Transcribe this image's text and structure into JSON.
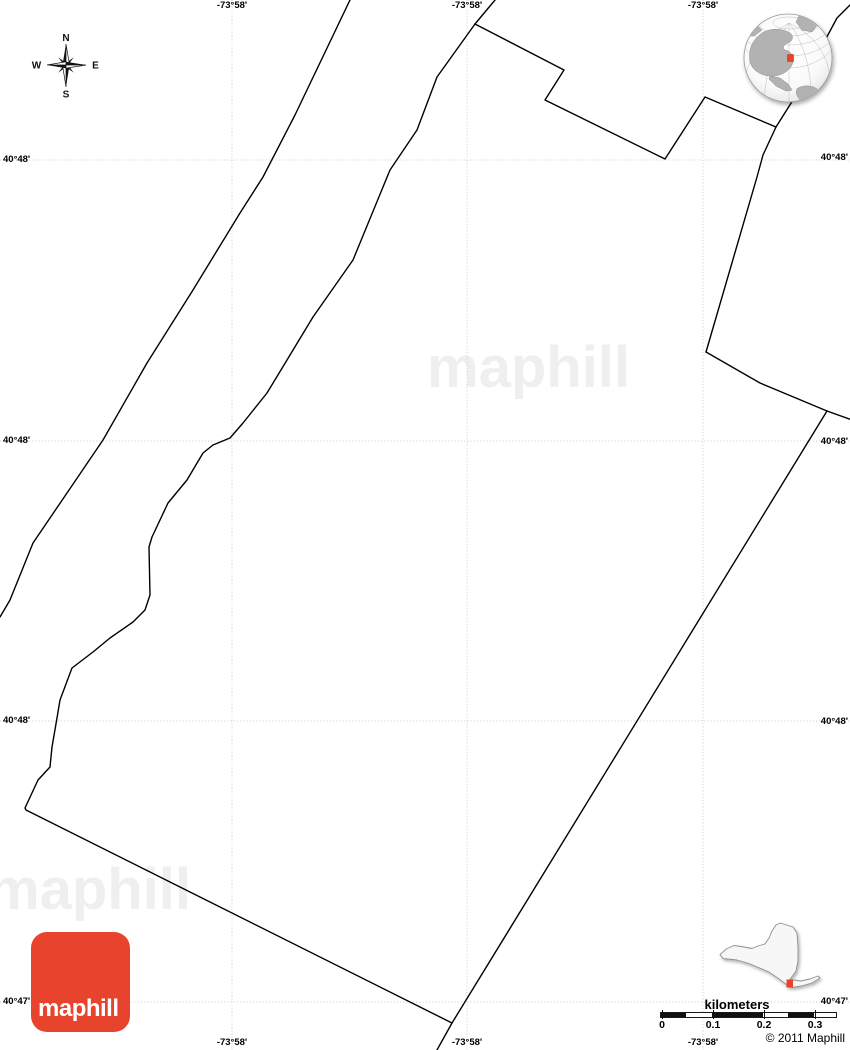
{
  "watermark": {
    "text": "maphill",
    "color": "#efefef"
  },
  "compass": {
    "north": "N",
    "east": "E",
    "south": "S",
    "west": "W"
  },
  "grid": {
    "line_color": "#cccccc",
    "vertical_x": [
      232,
      467,
      703
    ],
    "horizontal_y": [
      160,
      441,
      721,
      1002
    ],
    "top_labels": [
      "-73°58'",
      "-73°58'",
      "-73°58'"
    ],
    "bottom_labels": [
      "-73°58'",
      "-73°58'",
      "-73°58'"
    ],
    "left_labels": [
      "40°48'",
      "40°48'",
      "40°48'",
      "40°47'"
    ],
    "right_labels": [
      "40°48'",
      "40°48'",
      "40°48'",
      "40°47'"
    ]
  },
  "boundaries": {
    "color": "#000000",
    "lines": {
      "west_outer": [
        [
          350,
          0
        ],
        [
          295,
          115
        ],
        [
          263,
          177
        ],
        [
          240,
          213
        ],
        [
          193,
          290
        ],
        [
          147,
          363
        ],
        [
          103,
          440
        ],
        [
          67,
          493
        ],
        [
          33,
          543
        ],
        [
          10,
          600
        ],
        [
          0,
          617
        ]
      ],
      "district_west_south": [
        [
          495,
          0
        ],
        [
          475,
          24
        ],
        [
          437,
          77
        ],
        [
          417,
          130
        ],
        [
          390,
          170
        ],
        [
          353,
          260
        ],
        [
          313,
          317
        ],
        [
          287,
          360
        ],
        [
          267,
          393
        ],
        [
          243,
          423
        ],
        [
          230,
          438
        ],
        [
          213,
          445
        ],
        [
          203,
          453
        ],
        [
          187,
          480
        ],
        [
          168,
          503
        ],
        [
          152,
          537
        ],
        [
          149,
          547
        ],
        [
          150,
          595
        ],
        [
          145,
          610
        ],
        [
          133,
          622
        ],
        [
          110,
          638
        ],
        [
          93,
          652
        ],
        [
          72,
          668
        ],
        [
          60,
          700
        ],
        [
          57,
          718
        ],
        [
          52,
          747
        ],
        [
          50,
          767
        ],
        [
          38,
          780
        ],
        [
          25,
          808
        ],
        [
          26,
          810
        ],
        [
          452,
          1023
        ]
      ],
      "north_jagged": [
        [
          475,
          24
        ],
        [
          564,
          70
        ],
        [
          545,
          100
        ],
        [
          665,
          159
        ],
        [
          705,
          97
        ],
        [
          776,
          127
        ]
      ],
      "northeast_diagonal": [
        [
          850,
          5
        ],
        [
          837,
          18
        ],
        [
          793,
          100
        ],
        [
          776,
          127
        ],
        [
          763,
          155
        ],
        [
          757,
          177
        ],
        [
          706,
          352
        ]
      ],
      "northeast_corner": [
        [
          706,
          352
        ],
        [
          760,
          383
        ],
        [
          827,
          411
        ],
        [
          852,
          420
        ]
      ],
      "east": [
        [
          827,
          411
        ],
        [
          452,
          1023
        ],
        [
          437,
          1050
        ]
      ]
    }
  },
  "scalebar": {
    "title": "kilometers",
    "tick_labels": [
      "0",
      "0.1",
      "0.2",
      "0.3"
    ]
  },
  "branding": {
    "logo_text": "maphill",
    "logo_color": "#e8432c",
    "copyright": "© 2011 Maphill"
  },
  "locator": {
    "marker_color": "#e8432c"
  }
}
